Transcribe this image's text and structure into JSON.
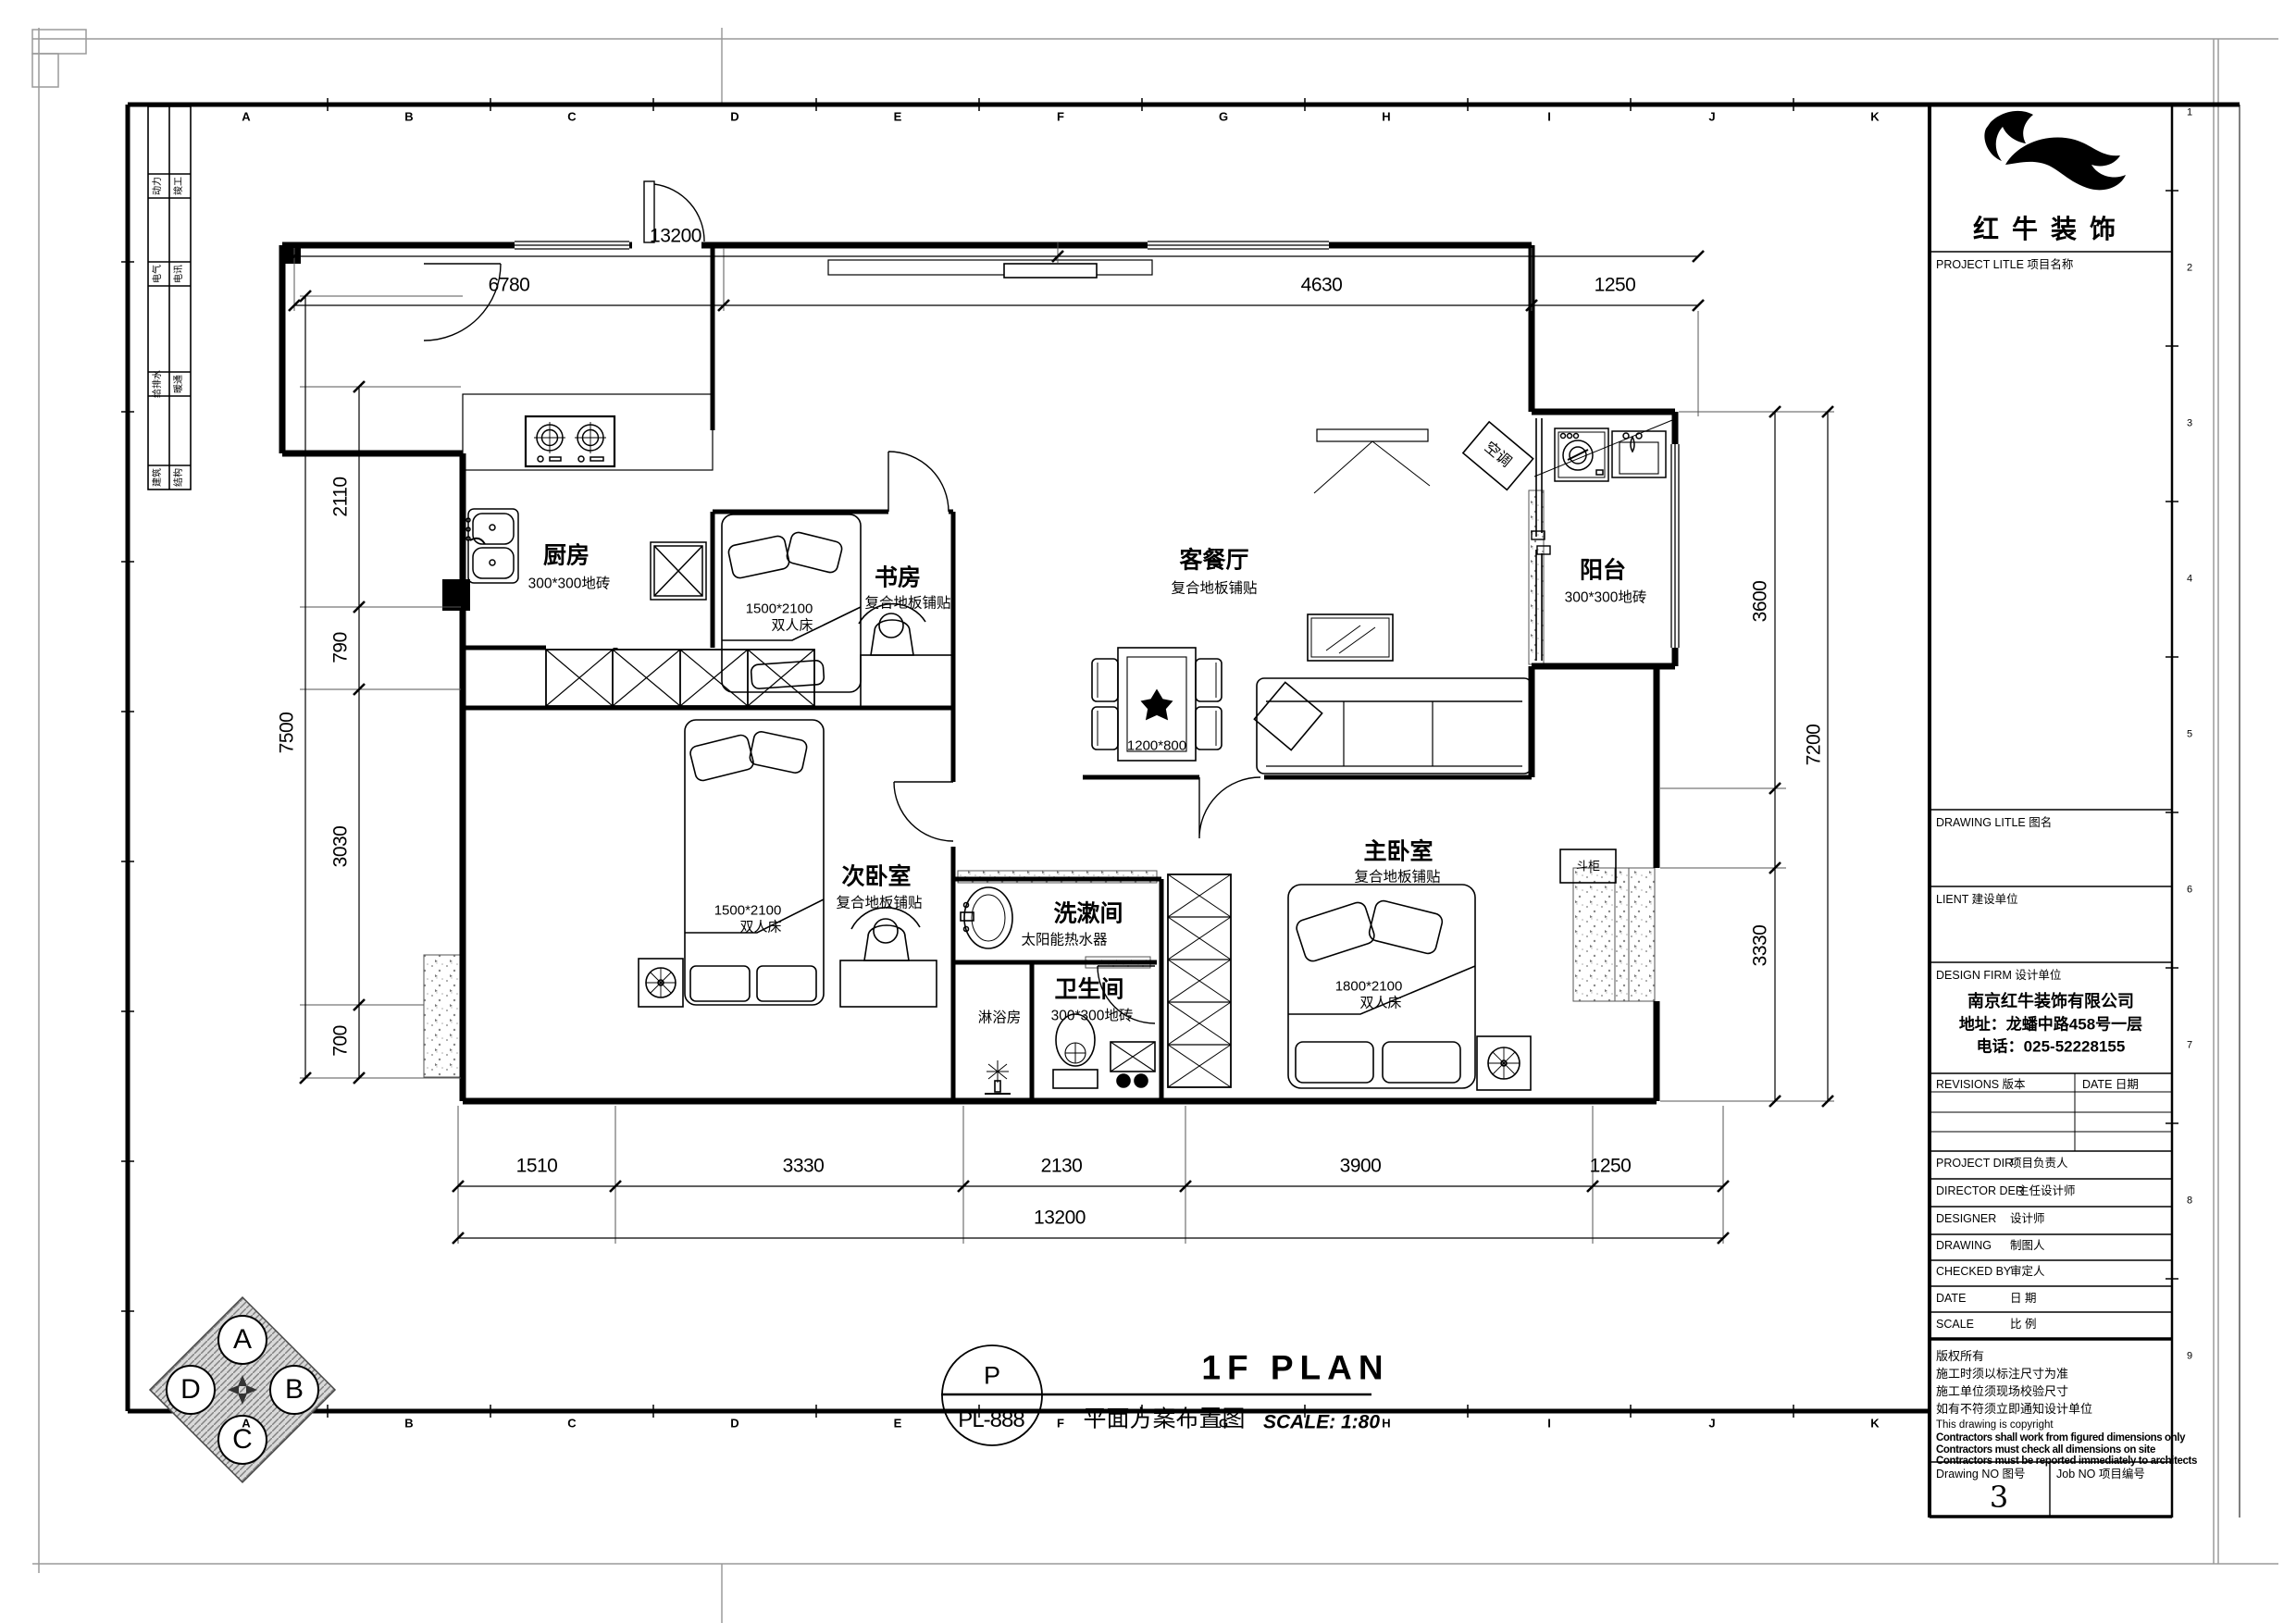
{
  "sheet": {
    "grid_letters": [
      "A",
      "B",
      "C",
      "D",
      "E",
      "F",
      "G",
      "H",
      "I",
      "J",
      "K"
    ],
    "grid_numbers": [
      "1",
      "2",
      "3",
      "4",
      "5",
      "6",
      "7",
      "8",
      "9"
    ],
    "discipline_table": [
      [
        "动力",
        "竣工"
      ],
      [
        "电气",
        "电讯"
      ],
      [
        "给排水",
        "暖通"
      ],
      [
        "建筑",
        "结构"
      ]
    ]
  },
  "rooms": {
    "kitchen": {
      "name": "厨房",
      "finish": "300*300地砖"
    },
    "study": {
      "name": "书房",
      "finish": "复合地板铺贴"
    },
    "living": {
      "name": "客餐厅",
      "finish": "复合地板铺贴"
    },
    "balcony": {
      "name": "阳台",
      "finish": "300*300地砖"
    },
    "second_bedroom": {
      "name": "次卧室",
      "finish": "复合地板铺贴"
    },
    "washroom": {
      "name": "洗漱间",
      "note": "太阳能热水器"
    },
    "shower": {
      "name": "淋浴房"
    },
    "bathroom": {
      "name": "卫生间",
      "finish": "300*300地砖"
    },
    "master_bedroom": {
      "name": "主卧室",
      "finish": "复合地板铺贴"
    }
  },
  "furniture": {
    "study_bed_size": "1500*2100",
    "study_bed_type": "双人床",
    "second_bed_size": "1500*2100",
    "second_bed_type": "双人床",
    "master_bed_size": "1800*2100",
    "master_bed_type": "双人床",
    "dining_table_size": "1200*800",
    "air_conditioner": "空调",
    "chest": "斗柜"
  },
  "dims": {
    "top": {
      "overall": "13200",
      "segments": [
        "6780",
        "4630",
        "1250"
      ]
    },
    "bottom": {
      "segments": [
        "1510",
        "3330",
        "2130",
        "3900",
        "1250"
      ],
      "overall": "13200"
    },
    "left": {
      "segments": [
        "2110",
        "790",
        "3030",
        "700"
      ],
      "overall": "7500"
    },
    "right": {
      "segments": [
        "3600",
        "3330"
      ],
      "overall": "7200"
    }
  },
  "titlebar": {
    "code_letter": "P",
    "code": "PL-888",
    "title_en": "1F PLAN",
    "title_cn": "平面方案布置图",
    "scale": "SCALE: 1:80"
  },
  "compass": {
    "north": "A",
    "east": "B",
    "south": "C",
    "west": "D"
  },
  "titleblock": {
    "brand": "红牛装饰",
    "project_label": "PROJECT LITLE  项目名称",
    "drawing_label": "DRAWING LITLE  图名",
    "client_label": "LIENT  建设单位",
    "firm_label": "DESIGN FIRM  设计单位",
    "company": "南京红牛装饰有限公司",
    "address": "地址：龙蟠中路458号一层",
    "phone": "电话：025-52228155",
    "revisions_label": "REVISIONS  版本",
    "date_col_label": "DATE  日期",
    "rows": [
      {
        "en": "PROJECT DIR",
        "cn": "项目负责人"
      },
      {
        "en": "DIRECTOR DER",
        "cn": "主任设计师"
      },
      {
        "en": "DESIGNER",
        "cn": "设计师"
      },
      {
        "en": "DRAWING",
        "cn": "制图人"
      },
      {
        "en": "CHECKED BY",
        "cn": "审定人"
      },
      {
        "en": "DATE",
        "cn": "日  期"
      },
      {
        "en": "SCALE",
        "cn": "比  例"
      }
    ],
    "notes": [
      "版权所有",
      "施工时须以标注尺寸为准",
      "施工单位须现场校验尺寸",
      "如有不符须立即通知设计单位",
      "This drawing is copyright",
      "Contractors shall work from figured dimensions only",
      "Contractors must check all dimensions on site",
      "Contractors must be reported immediately to architects"
    ],
    "drawing_no_label": "Drawing NO  图号",
    "drawing_no": "3",
    "job_no_label": "Job NO  项目编号"
  }
}
